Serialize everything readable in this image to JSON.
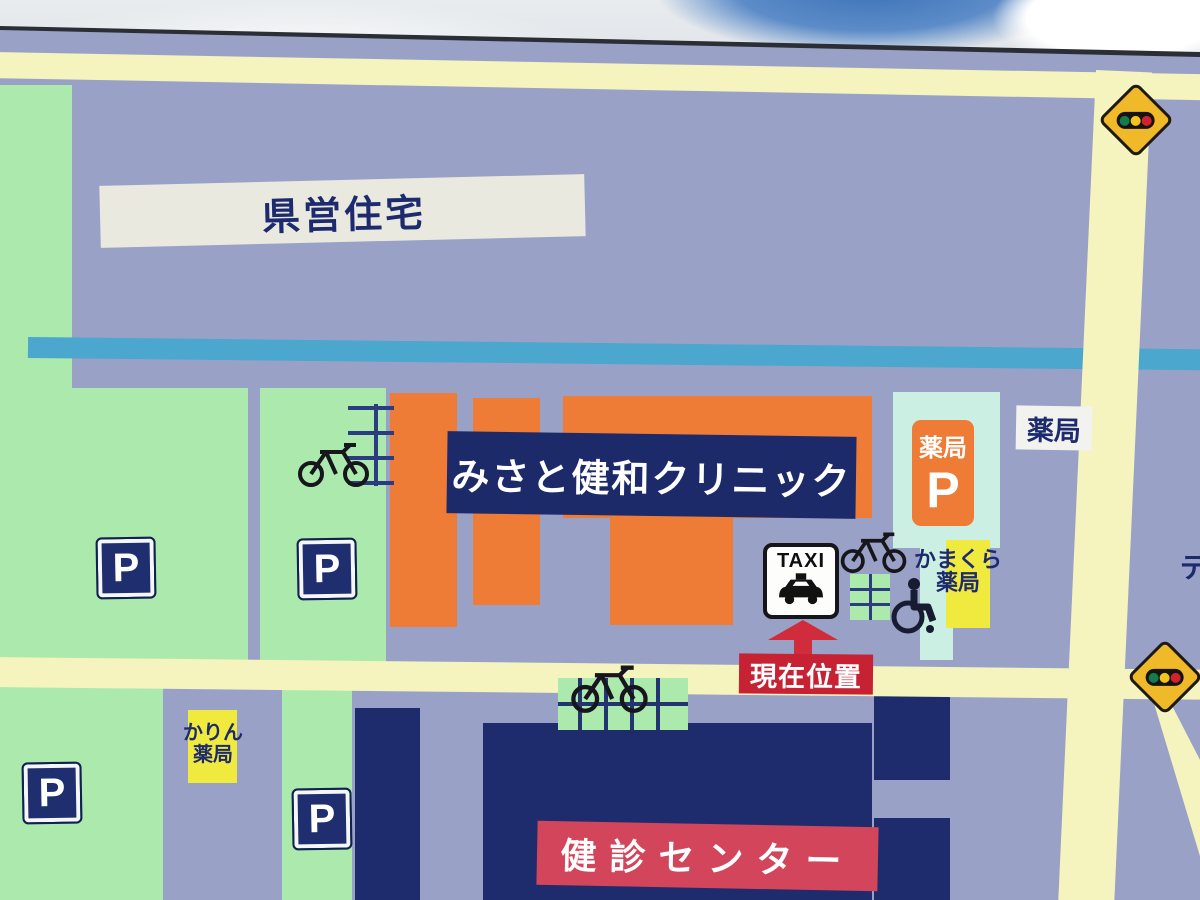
{
  "signboard": {
    "type": "clinic-area-guide-map",
    "labels": {
      "prefectural_housing": "県営住宅",
      "clinic": "みさと健和クリニック",
      "pharmacy_parking_label": "薬局",
      "pharmacy_parking_p": "P",
      "pharmacy": "薬局",
      "kamakura_pharmacy_line1": "かまくら",
      "kamakura_pharmacy_line2": "薬局",
      "karin_pharmacy_line1": "かりん",
      "karin_pharmacy_line2": "薬局",
      "taxi": "TAXI",
      "current_location": "現在位置",
      "checkup_center": "健診センター",
      "parking_p": "P",
      "right_edge_partial": "デ"
    },
    "icons": {
      "taxi_stand": "taxi-car-icon",
      "bicycle_parking": "bicycle-icon",
      "bicycle_rack": "bicycle-rack-icon",
      "wheelchair_access": "wheelchair-icon",
      "traffic_signal_warning": "traffic-signal-sign-icon",
      "parking": "parking-p-sign-icon",
      "you_are_here": "up-arrow-icon"
    },
    "colors": {
      "board_background": "#9aa1c7",
      "road": "#f5f4be",
      "parking_green": "#abe9ad",
      "building_orange": "#ee7b36",
      "building_navy": "#1e2c6e",
      "river_stripe_cyan": "#4ba7cd",
      "walkway_cyan": "#cbf0e3",
      "checkup_banner_red": "#d2455a",
      "current_location_red": "#c62233",
      "pharmacy_yellow_box": "#f1ea3e",
      "housing_band_white": "#e9e9e0",
      "sign_diamond_yellow": "#f0b929",
      "sky_blue": "#3d72b8"
    }
  }
}
